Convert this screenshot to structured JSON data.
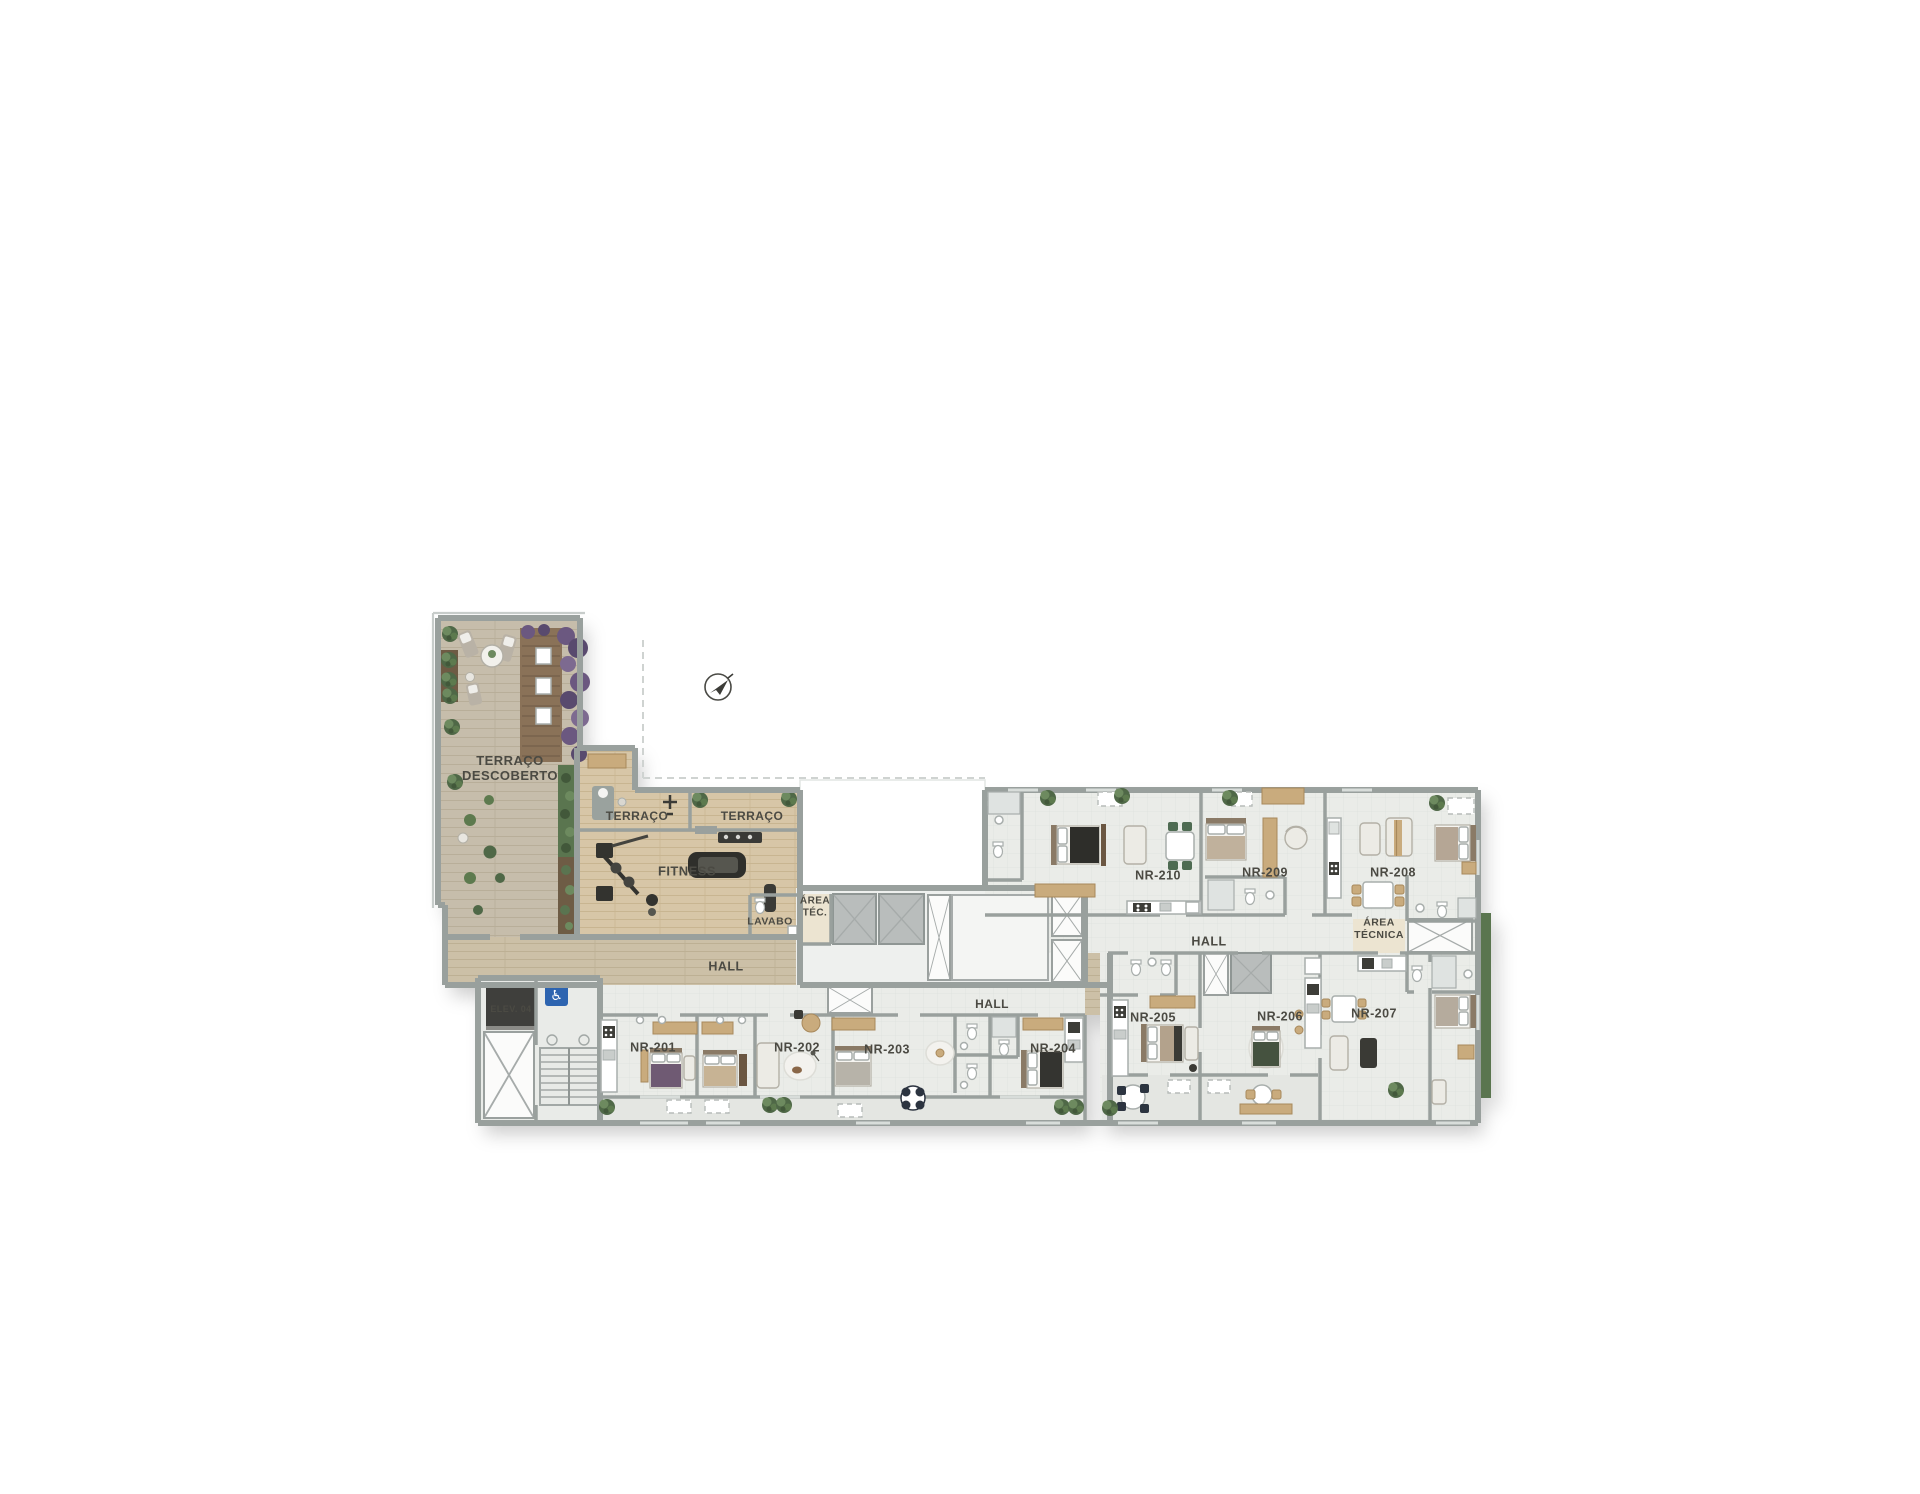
{
  "plan": {
    "colors": {
      "wall": "#99a09d",
      "wallLight": "#c7ccca",
      "woodTerrace": "#c6bdab",
      "woodFitness": "#d7c6a7",
      "woodHall": "#ccc0a7",
      "unitFloor": "#eaece8",
      "balcony": "#e4e6e2",
      "beige": "#ece4d1",
      "accentBlue": "#2d64b0",
      "hedge": "#5a7450",
      "purple": "#6b5880",
      "labelInk": "#4b4a43"
    },
    "compass": {
      "icon": "north-arrow-icon",
      "x": 718,
      "y": 687
    },
    "labels": [
      {
        "id": "terraco-descoberto",
        "lines": [
          "TERRAÇO",
          "DESCOBERTO"
        ],
        "x": 510,
        "y": 768,
        "size": 13
      },
      {
        "id": "terraco-1",
        "lines": [
          "TERRAÇO"
        ],
        "x": 637,
        "y": 816,
        "size": 12
      },
      {
        "id": "terraco-2",
        "lines": [
          "TERRAÇO"
        ],
        "x": 752,
        "y": 816,
        "size": 12
      },
      {
        "id": "fitness",
        "lines": [
          "FITNESS"
        ],
        "x": 687,
        "y": 871,
        "size": 13
      },
      {
        "id": "lavabo",
        "lines": [
          "LAVABO"
        ],
        "x": 770,
        "y": 921,
        "size": 10.5
      },
      {
        "id": "area-tec",
        "lines": [
          "ÁREA",
          "TÉC."
        ],
        "x": 815,
        "y": 906,
        "size": 10
      },
      {
        "id": "hall-left",
        "lines": [
          "HALL"
        ],
        "x": 726,
        "y": 966,
        "size": 12.5
      },
      {
        "id": "hall-center",
        "lines": [
          "HALL"
        ],
        "x": 992,
        "y": 1004,
        "size": 12
      },
      {
        "id": "hall-right",
        "lines": [
          "HALL"
        ],
        "x": 1209,
        "y": 941,
        "size": 12.5
      },
      {
        "id": "area-tecnica",
        "lines": [
          "ÁREA",
          "TÉCNICA"
        ],
        "x": 1379,
        "y": 928,
        "size": 10.5
      },
      {
        "id": "elev-04",
        "lines": [
          "ELEV. 04"
        ],
        "x": 511,
        "y": 1009,
        "size": 9,
        "color": "#f4f4f2"
      },
      {
        "id": "nr-201",
        "lines": [
          "NR-201"
        ],
        "x": 653,
        "y": 1047,
        "size": 12.5
      },
      {
        "id": "nr-202",
        "lines": [
          "NR-202"
        ],
        "x": 797,
        "y": 1047,
        "size": 12.5
      },
      {
        "id": "nr-203",
        "lines": [
          "NR-203"
        ],
        "x": 887,
        "y": 1049,
        "size": 12.5
      },
      {
        "id": "nr-204",
        "lines": [
          "NR-204"
        ],
        "x": 1053,
        "y": 1048,
        "size": 12.5
      },
      {
        "id": "nr-205",
        "lines": [
          "NR-205"
        ],
        "x": 1153,
        "y": 1017,
        "size": 12.5
      },
      {
        "id": "nr-206",
        "lines": [
          "NR-206"
        ],
        "x": 1280,
        "y": 1016,
        "size": 12.5
      },
      {
        "id": "nr-207",
        "lines": [
          "NR-207"
        ],
        "x": 1374,
        "y": 1013,
        "size": 12.5
      },
      {
        "id": "nr-208",
        "lines": [
          "NR-208"
        ],
        "x": 1393,
        "y": 872,
        "size": 12.5
      },
      {
        "id": "nr-209",
        "lines": [
          "NR-209"
        ],
        "x": 1265,
        "y": 872,
        "size": 12.5
      },
      {
        "id": "nr-210",
        "lines": [
          "NR-210"
        ],
        "x": 1158,
        "y": 875,
        "size": 12.5
      }
    ]
  }
}
